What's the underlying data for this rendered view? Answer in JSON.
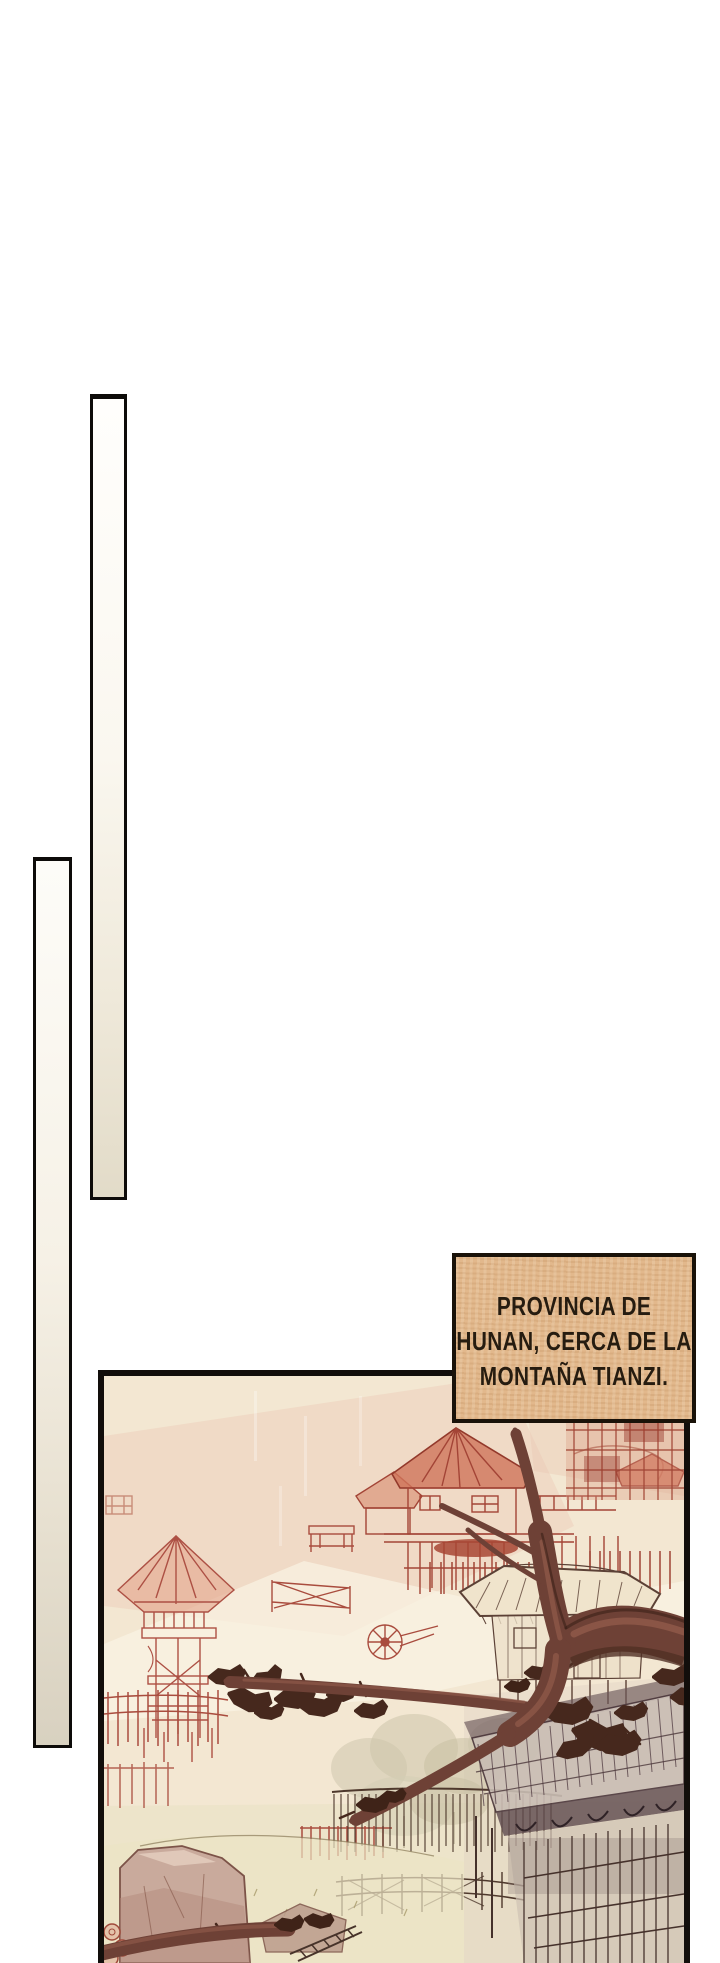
{
  "page": {
    "background": "#ffffff"
  },
  "caption": {
    "lines": [
      "PROVINCIA DE",
      "HUNAN, CERCA DE LA",
      "MONTAÑA TIANZI."
    ],
    "text": "PROVINCIA DE HUNAN, CERCA DE LA MONTAÑA TIANZI.",
    "colors": {
      "background": "#e2b88c",
      "border": "#191209",
      "text": "#261c10"
    }
  },
  "panel": {
    "description": "Hand-drawn parchment sketch of a stilt-house village: watchtower, stilt houses and scaffolding in red ink, thatched hut, fences, cart wheel, rocks, a large dark bare tree branch with leaf clusters crossing the foreground and a big slanted-roof building at lower right.",
    "colors": {
      "border": "#120e0b",
      "parchment": "#f3e7d2",
      "sketch_red": "#b2544a",
      "ink_brown": "#53392e",
      "branch": "#6e4136"
    }
  },
  "decorations": {
    "bars": [
      {
        "name": "tall-bar-right",
        "fill_top": "#fffefc",
        "fill_bottom": "#e2dbc8",
        "border": "#0d0b09"
      },
      {
        "name": "tall-bar-left",
        "fill_top": "#fdfcf8",
        "fill_bottom": "#d8d1c0",
        "border": "#0d0b09"
      }
    ]
  }
}
